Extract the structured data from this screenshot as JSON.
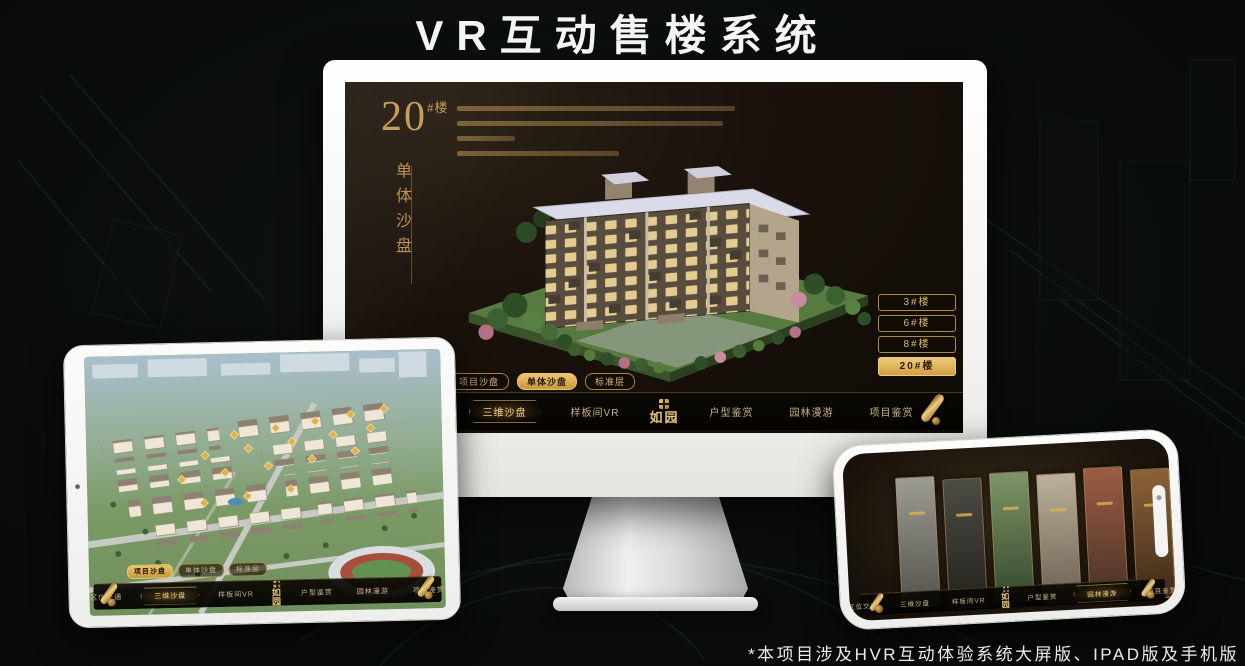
{
  "page": {
    "title": "VR互动售楼系统",
    "footnote": "*本项目涉及HVR互动体验系统大屏版、IPAD版及手机版"
  },
  "colors": {
    "gold": "#c9a050",
    "gold_bright": "#eecb7c",
    "gold_deep": "#8a6428",
    "screen_bg": "#15100a",
    "nav_text": "#c9b489",
    "nav_active_text": "#f3d490"
  },
  "sales_app": {
    "headline": {
      "number": "20",
      "suffix": "#楼",
      "subtitle": "单体沙盘"
    },
    "building_buttons": [
      {
        "label": "3#楼",
        "active": false
      },
      {
        "label": "6#楼",
        "active": false
      },
      {
        "label": "8#楼",
        "active": false
      },
      {
        "label": "20#楼",
        "active": true
      }
    ],
    "floor_tabs": [
      {
        "label": "项目沙盘",
        "active": false
      },
      {
        "label": "单体沙盘",
        "active": true
      },
      {
        "label": "标准层",
        "active": false
      }
    ],
    "tablet_tabs": [
      {
        "label": "项目沙盘",
        "active": true
      },
      {
        "label": "单体沙盘",
        "active": false
      },
      {
        "label": "标准层",
        "active": false
      }
    ],
    "logo": "如园",
    "nav_items": [
      {
        "label": "区位交通",
        "active": false
      },
      {
        "label": "三维沙盘",
        "active": true
      },
      {
        "label": "样板间VR",
        "active": false
      },
      {
        "label": "户型鉴赏",
        "active": false
      },
      {
        "label": "园林漫游",
        "active": false
      },
      {
        "label": "项目鉴赏",
        "active": false
      }
    ]
  },
  "phone": {
    "panels": [
      {
        "bg": "linear-gradient(#9c9c94,#54524a)"
      },
      {
        "bg": "linear-gradient(#4c4c44,#23211c)"
      },
      {
        "bg": "linear-gradient(#7e9569,#34492b)"
      },
      {
        "bg": "linear-gradient(#bbb09a,#6b6052)"
      },
      {
        "bg": "linear-gradient(#9c5c44,#4a3328)"
      },
      {
        "bg": "linear-gradient(#8c6239,#3f2a18)"
      }
    ]
  }
}
